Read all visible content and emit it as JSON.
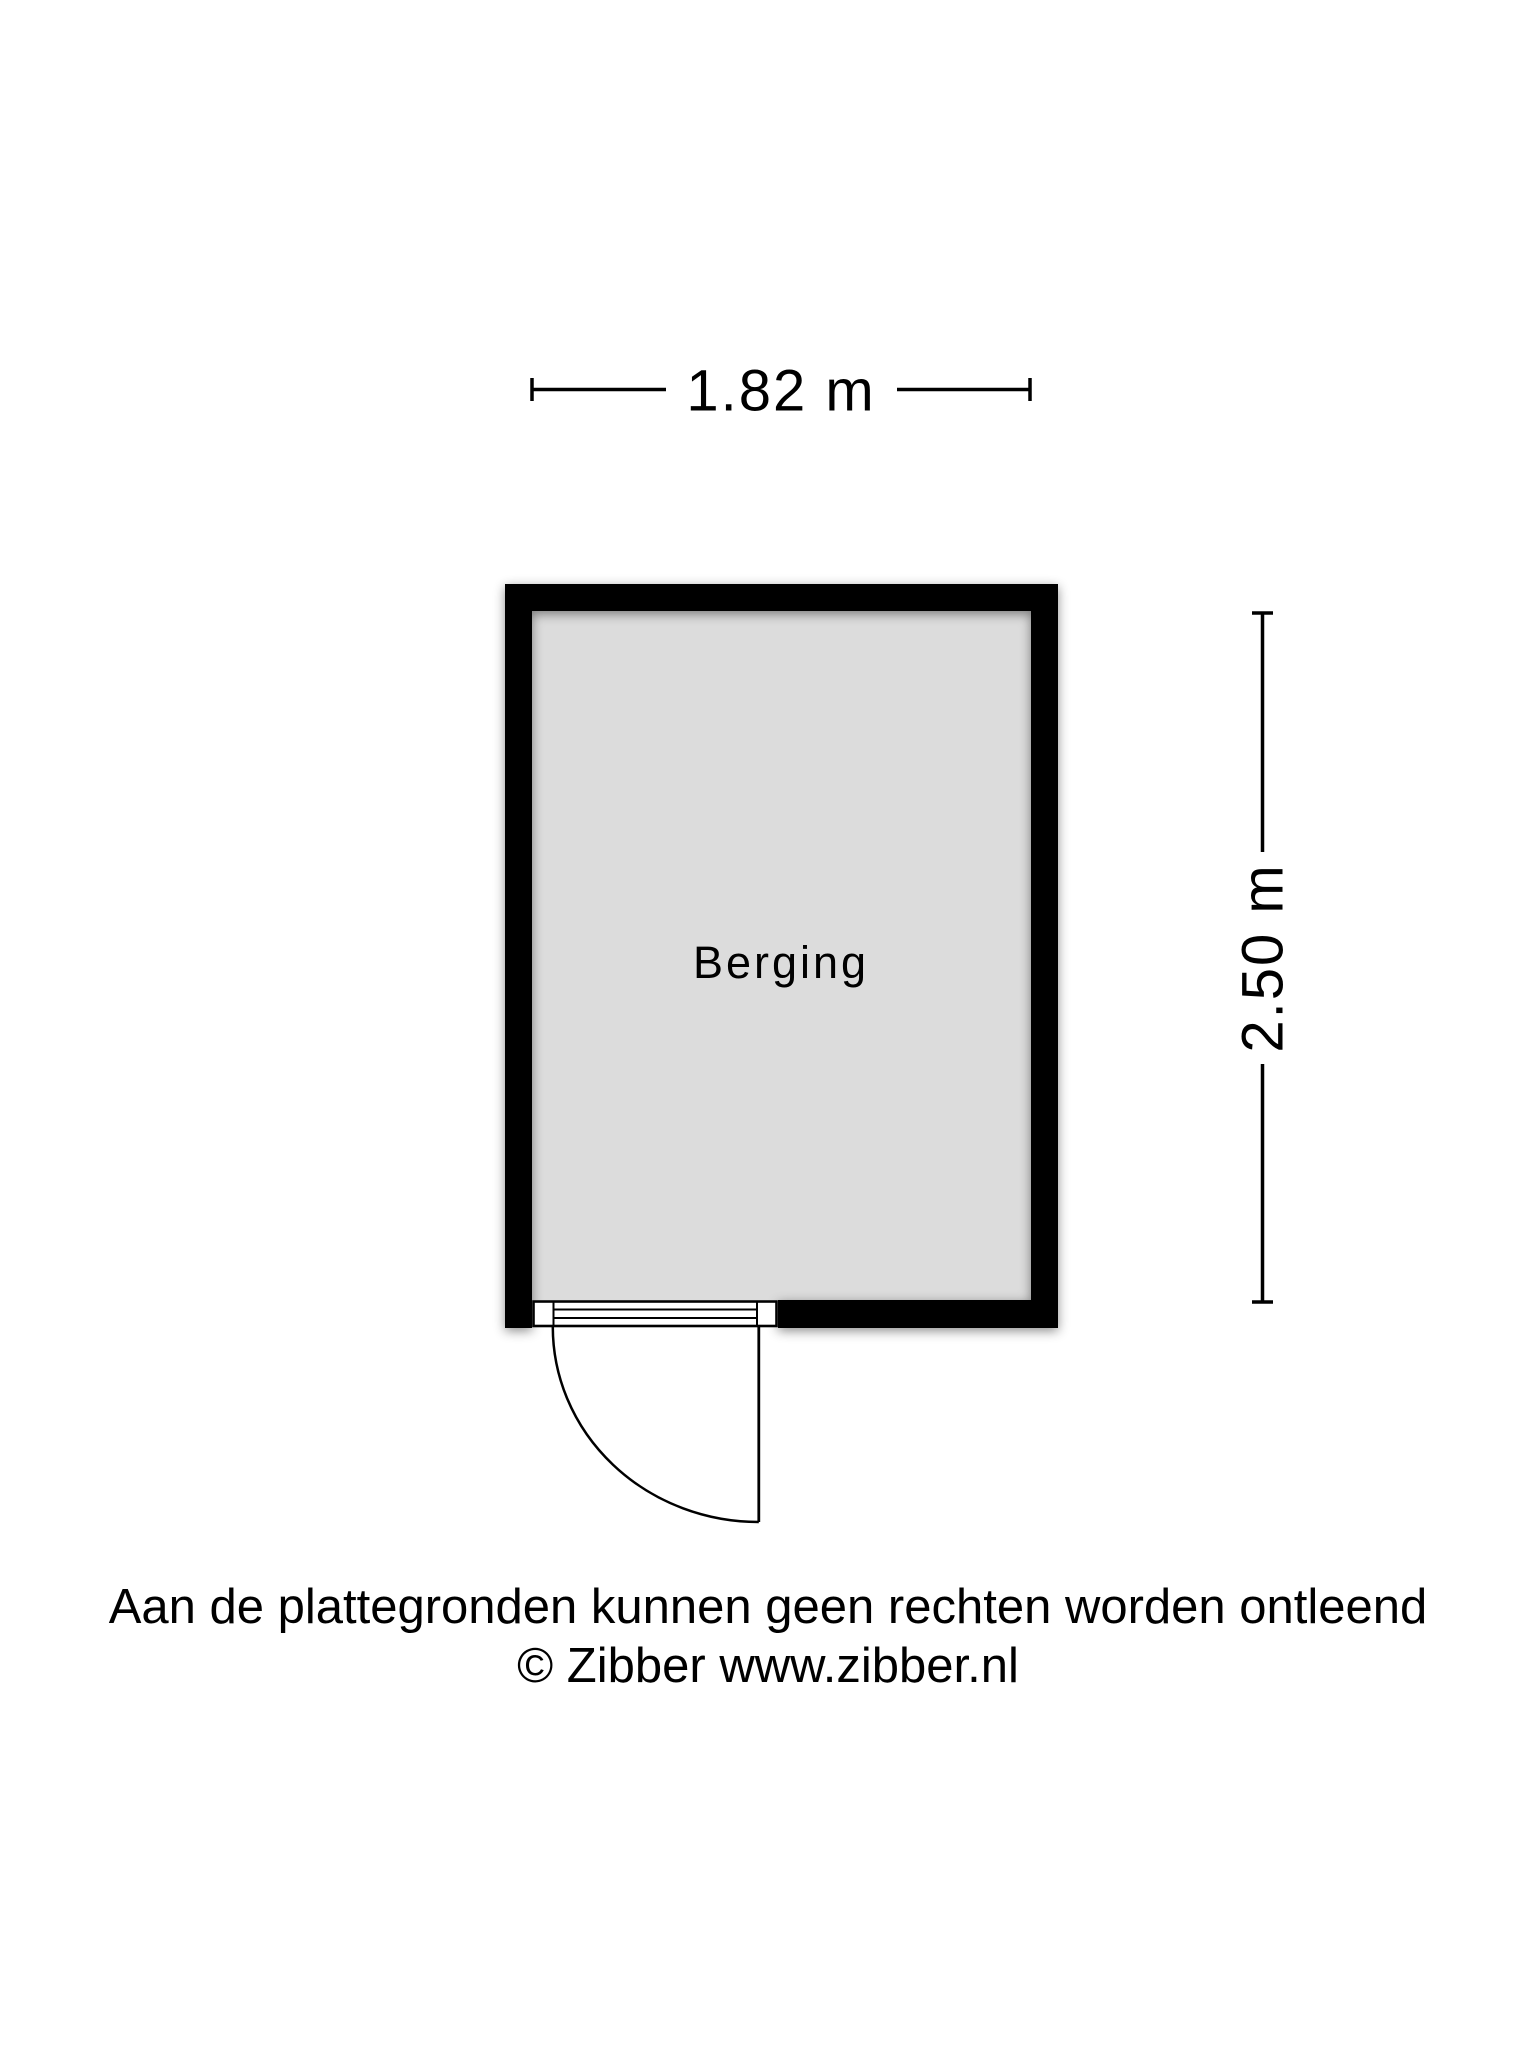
{
  "floor_plan": {
    "room": {
      "label": "Berging",
      "floor_color": "#dcdcdc",
      "wall_color": "#000000"
    },
    "dimensions": {
      "width_label": "1.82 m",
      "height_label": "2.50 m"
    },
    "footer": {
      "disclaimer": "Aan de plattegronden kunnen geen rechten worden ontleend",
      "copyright": "© Zibber www.zibber.nl"
    },
    "colors": {
      "background": "#ffffff",
      "text": "#000000"
    }
  }
}
